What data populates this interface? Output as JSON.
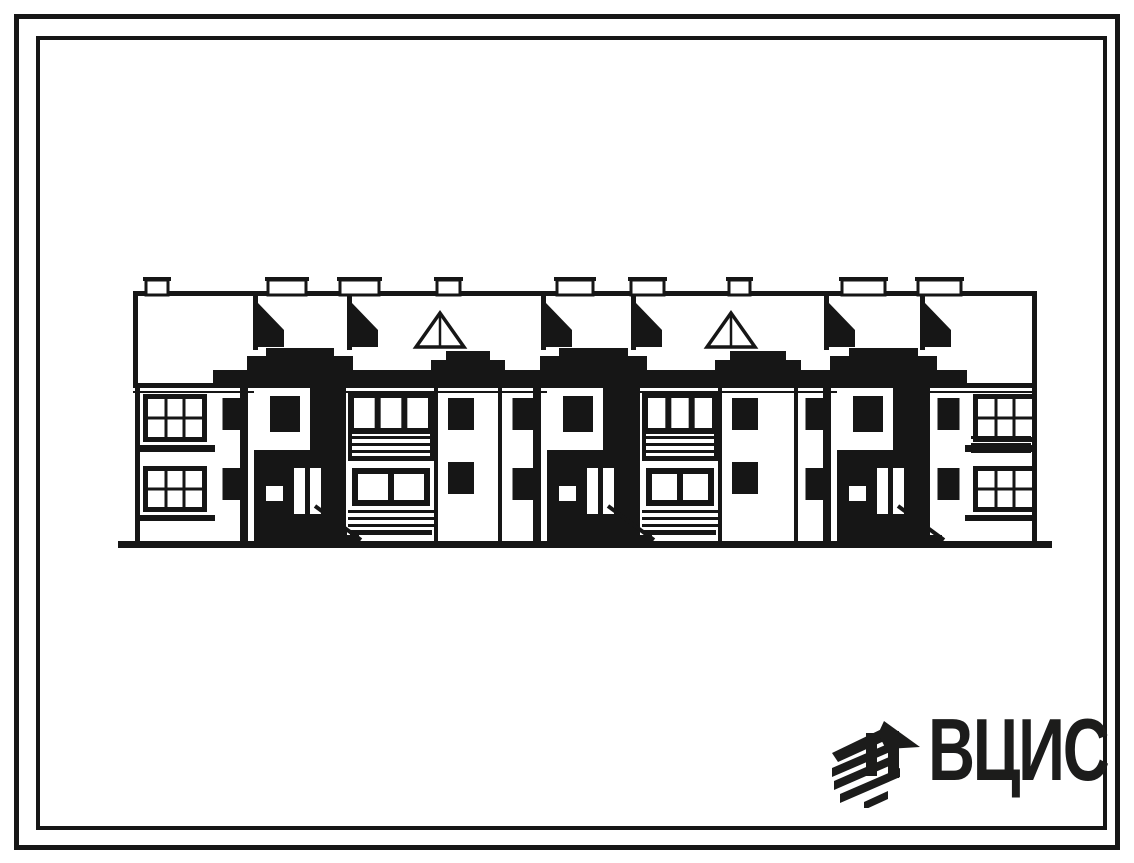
{
  "page": {
    "background": "#ffffff",
    "ink": "#161616"
  },
  "logo": {
    "text": "ВЦИС",
    "icon": "diagonal-hatch-construction-mark",
    "color": "#1c1c1b"
  },
  "drawing": {
    "type": "building-elevation",
    "eaves": {
      "x": 133,
      "y": 291,
      "w": 904,
      "leftDrop": 94,
      "rightDrop": 99
    },
    "fascia": {
      "x": 133,
      "y": 383,
      "w": 904
    },
    "ground": {
      "x": 118,
      "y": 541,
      "w": 934,
      "h": 7
    },
    "chimneys": [
      {
        "x": 146,
        "w": 22
      },
      {
        "x": 268,
        "w": 38
      },
      {
        "x": 340,
        "w": 39
      },
      {
        "x": 437,
        "w": 23
      },
      {
        "x": 557,
        "w": 36
      },
      {
        "x": 631,
        "w": 33
      },
      {
        "x": 729,
        "w": 21
      },
      {
        "x": 842,
        "w": 43
      },
      {
        "x": 918,
        "w": 43
      }
    ],
    "dormers": [
      253,
      347,
      541,
      631,
      824,
      920
    ],
    "vents": [
      440,
      731
    ],
    "endBays": [
      {
        "x": 135,
        "w": 80,
        "rails": false,
        "edge": "left"
      },
      {
        "x": 965,
        "w": 72,
        "rails": true,
        "edge": "right"
      }
    ],
    "piers": [
      {
        "x": 215,
        "w": 37
      },
      {
        "x": 502,
        "w": 43
      },
      {
        "x": 798,
        "w": 37
      },
      {
        "x": 932,
        "w": 33
      }
    ],
    "balconies": [
      {
        "x": 348,
        "w": 86
      },
      {
        "x": 642,
        "w": 76
      }
    ],
    "whiteTowers": [
      {
        "x": 434,
        "w": 68
      },
      {
        "x": 718,
        "w": 80
      }
    ],
    "entryTowers": [
      {
        "x": 252,
        "w": 96
      },
      {
        "x": 545,
        "w": 97
      },
      {
        "x": 835,
        "w": 97
      }
    ]
  }
}
